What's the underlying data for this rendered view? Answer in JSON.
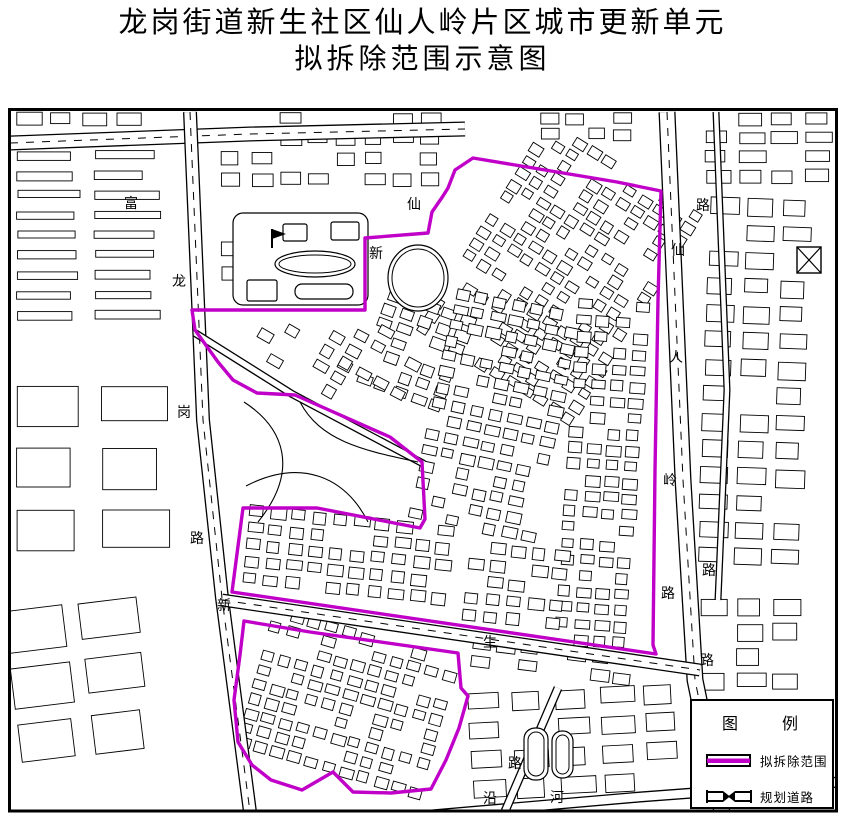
{
  "title": {
    "line1": "龙岗街道新生社区仙人岭片区城市更新单元",
    "line2": "拟拆除范围示意图"
  },
  "legend": {
    "title": "图　例",
    "items": [
      {
        "label": "拟拆除范围",
        "symbol": "demolition-boundary"
      },
      {
        "label": "规划道路",
        "symbol": "planned-road"
      }
    ]
  },
  "colors": {
    "ink": "#000000",
    "paper": "#ffffff",
    "boundary": "#c000c8"
  },
  "map": {
    "labels": [
      {
        "t": "富",
        "x": 131,
        "y": 208
      },
      {
        "t": "龙",
        "x": 179,
        "y": 286
      },
      {
        "t": "岗",
        "x": 184,
        "y": 417
      },
      {
        "t": "路",
        "x": 197,
        "y": 543
      },
      {
        "t": "仙",
        "x": 414,
        "y": 209
      },
      {
        "t": "新",
        "x": 376,
        "y": 258
      },
      {
        "t": "仙",
        "x": 678,
        "y": 255
      },
      {
        "t": "人",
        "x": 676,
        "y": 362
      },
      {
        "t": "岭",
        "x": 670,
        "y": 485
      },
      {
        "t": "路",
        "x": 668,
        "y": 598
      },
      {
        "t": "路",
        "x": 703,
        "y": 210
      },
      {
        "t": "路",
        "x": 709,
        "y": 575
      },
      {
        "t": "路",
        "x": 707,
        "y": 665
      },
      {
        "t": "新",
        "x": 224,
        "y": 610
      },
      {
        "t": "生",
        "x": 490,
        "y": 647
      },
      {
        "t": "路",
        "x": 515,
        "y": 768
      },
      {
        "t": "沿",
        "x": 490,
        "y": 803
      },
      {
        "t": "河",
        "x": 557,
        "y": 802
      }
    ],
    "boundary_main": [
      [
        473,
        158
      ],
      [
        617,
        182
      ],
      [
        661,
        191
      ],
      [
        658,
        300
      ],
      [
        655,
        470
      ],
      [
        653,
        645
      ],
      [
        656,
        654
      ],
      [
        232,
        592
      ],
      [
        243,
        508
      ],
      [
        317,
        508
      ],
      [
        420,
        528
      ],
      [
        425,
        519
      ],
      [
        422,
        462
      ],
      [
        390,
        437
      ],
      [
        295,
        395
      ],
      [
        257,
        393
      ],
      [
        233,
        380
      ],
      [
        218,
        362
      ],
      [
        195,
        330
      ],
      [
        192,
        310
      ],
      [
        365,
        310
      ],
      [
        365,
        238
      ],
      [
        428,
        233
      ],
      [
        432,
        212
      ],
      [
        443,
        196
      ],
      [
        448,
        188
      ],
      [
        455,
        170
      ]
    ],
    "boundary_south": [
      [
        244,
        621
      ],
      [
        310,
        632
      ],
      [
        458,
        653
      ],
      [
        461,
        688
      ],
      [
        468,
        696
      ],
      [
        459,
        728
      ],
      [
        446,
        760
      ],
      [
        431,
        789
      ],
      [
        391,
        793
      ],
      [
        353,
        792
      ],
      [
        333,
        772
      ],
      [
        302,
        790
      ],
      [
        271,
        780
      ],
      [
        252,
        765
      ],
      [
        238,
        742
      ],
      [
        234,
        700
      ],
      [
        240,
        655
      ]
    ],
    "roads": [
      {
        "pts": [
          [
            10,
            143
          ],
          [
            250,
            134
          ],
          [
            465,
            129
          ]
        ],
        "w": 15,
        "dash": true
      },
      {
        "pts": [
          [
            190,
            112
          ],
          [
            203,
            420
          ],
          [
            222,
            598
          ],
          [
            250,
            812
          ]
        ],
        "w": 14,
        "dash": true
      },
      {
        "pts": [
          [
            667,
            112
          ],
          [
            683,
            480
          ],
          [
            695,
            680
          ],
          [
            722,
            812
          ]
        ],
        "w": 17,
        "dash": true
      },
      {
        "pts": [
          [
            222,
            600
          ],
          [
            700,
            670
          ]
        ],
        "w": 13,
        "dash": true
      },
      {
        "pts": [
          [
            420,
            816
          ],
          [
            640,
            797
          ],
          [
            840,
            782
          ]
        ],
        "w": 11,
        "dash": false
      },
      {
        "pts": [
          [
            558,
            688
          ],
          [
            503,
            816
          ]
        ],
        "w": 9,
        "dash": false
      },
      {
        "pts": [
          [
            716,
            112
          ],
          [
            727,
            390
          ],
          [
            718,
            600
          ]
        ],
        "w": 7,
        "dash": false
      },
      {
        "pts": [
          [
            195,
            333
          ],
          [
            292,
            394
          ],
          [
            424,
            464
          ]
        ],
        "w": 8,
        "dash": false
      }
    ],
    "clusters": [
      {
        "x": 16,
        "y": 112,
        "w": 170,
        "h": 24,
        "a": 0,
        "cw": 26,
        "ch": 13,
        "gx": 7,
        "gy": 6,
        "d": 0.85
      },
      {
        "x": 16,
        "y": 150,
        "w": 162,
        "h": 180,
        "a": 0,
        "cw": 66,
        "ch": 9,
        "gx": 12,
        "gy": 11,
        "d": 0.92
      },
      {
        "x": 16,
        "y": 385,
        "w": 168,
        "h": 200,
        "a": 0,
        "cw": 70,
        "ch": 44,
        "gx": 15,
        "gy": 18,
        "d": 0.85
      },
      {
        "x": 14,
        "y": 598,
        "w": 210,
        "h": 208,
        "a": -7,
        "cw": 62,
        "ch": 42,
        "gx": 13,
        "gy": 15,
        "d": 0.85
      },
      {
        "x": 252,
        "y": 112,
        "w": 205,
        "h": 88,
        "a": 0,
        "cw": 21,
        "ch": 13,
        "gx": 7,
        "gy": 7,
        "d": 0.7
      },
      {
        "x": 468,
        "y": 148,
        "w": 185,
        "h": 250,
        "a": 32,
        "cw": 13,
        "ch": 10,
        "gx": 4,
        "gy": 4,
        "d": 0.75
      },
      {
        "x": 540,
        "y": 112,
        "w": 112,
        "h": 30,
        "a": 0,
        "cw": 19,
        "ch": 11,
        "gx": 5,
        "gy": 5,
        "d": 0.8
      },
      {
        "x": 368,
        "y": 300,
        "w": 95,
        "h": 112,
        "a": 20,
        "cw": 15,
        "ch": 11,
        "gx": 4,
        "gy": 4,
        "d": 0.75
      },
      {
        "x": 430,
        "y": 298,
        "w": 132,
        "h": 244,
        "a": 12,
        "cw": 15,
        "ch": 11,
        "gx": 4,
        "gy": 5,
        "d": 0.78
      },
      {
        "x": 566,
        "y": 300,
        "w": 88,
        "h": 348,
        "a": 4,
        "cw": 15,
        "ch": 11,
        "gx": 4,
        "gy": 5,
        "d": 0.85
      },
      {
        "x": 345,
        "y": 330,
        "w": 82,
        "h": 60,
        "a": 28,
        "cw": 15,
        "ch": 11,
        "gx": 5,
        "gy": 5,
        "d": 0.55
      },
      {
        "x": 245,
        "y": 515,
        "w": 215,
        "h": 80,
        "a": 6,
        "cw": 16,
        "ch": 12,
        "gx": 5,
        "gy": 5,
        "d": 0.85
      },
      {
        "x": 465,
        "y": 545,
        "w": 100,
        "h": 96,
        "a": 6,
        "cw": 16,
        "ch": 12,
        "gx": 5,
        "gy": 5,
        "d": 0.8
      },
      {
        "x": 250,
        "y": 630,
        "w": 200,
        "h": 150,
        "a": 16,
        "cw": 14,
        "ch": 11,
        "gx": 4,
        "gy": 4,
        "d": 0.78
      },
      {
        "x": 705,
        "y": 112,
        "w": 130,
        "h": 78,
        "a": 0,
        "cw": 27,
        "ch": 13,
        "gx": 6,
        "gy": 6,
        "d": 0.85
      },
      {
        "x": 703,
        "y": 198,
        "w": 133,
        "h": 384,
        "a": 2,
        "cw": 29,
        "ch": 18,
        "gx": 8,
        "gy": 9,
        "d": 0.8
      },
      {
        "x": 700,
        "y": 598,
        "w": 136,
        "h": 92,
        "a": 0,
        "cw": 29,
        "ch": 17,
        "gx": 7,
        "gy": 8,
        "d": 0.75
      },
      {
        "x": 470,
        "y": 688,
        "w": 216,
        "h": 118,
        "a": -3,
        "cw": 35,
        "ch": 20,
        "gx": 9,
        "gy": 9,
        "d": 0.7
      },
      {
        "x": 470,
        "y": 648,
        "w": 185,
        "h": 34,
        "a": 7,
        "cw": 19,
        "ch": 12,
        "gx": 5,
        "gy": 5,
        "d": 0.6
      },
      {
        "x": 220,
        "y": 150,
        "w": 30,
        "h": 185,
        "a": 0,
        "cw": 22,
        "ch": 14,
        "gx": 6,
        "gy": 9,
        "d": 0.6
      },
      {
        "x": 255,
        "y": 318,
        "w": 100,
        "h": 68,
        "a": 30,
        "cw": 15,
        "ch": 11,
        "gx": 6,
        "gy": 6,
        "d": 0.5
      }
    ],
    "features": [
      {
        "type": "rrect",
        "x": 233,
        "y": 213,
        "w": 135,
        "h": 92,
        "r": 10
      },
      {
        "type": "ellipse",
        "cx": 315,
        "cy": 264,
        "rx": 40,
        "ry": 13,
        "dbl": true
      },
      {
        "type": "rrect",
        "x": 295,
        "y": 284,
        "w": 58,
        "h": 15,
        "r": 7
      },
      {
        "type": "rrect",
        "x": 283,
        "y": 224,
        "w": 24,
        "h": 17,
        "r": 2
      },
      {
        "type": "rrect",
        "x": 331,
        "y": 222,
        "w": 28,
        "h": 18,
        "r": 2
      },
      {
        "type": "rrect",
        "x": 247,
        "y": 280,
        "w": 30,
        "h": 21,
        "r": 2
      },
      {
        "type": "flag",
        "x": 272,
        "y": 229
      },
      {
        "type": "ellipse",
        "cx": 418,
        "cy": 278,
        "rx": 30,
        "ry": 33,
        "dbl": true
      },
      {
        "type": "path",
        "d": "M244,402 C284,428 300,470 258,522"
      },
      {
        "type": "path",
        "d": "M246,486 C300,458 345,476 368,522"
      },
      {
        "type": "path",
        "d": "M300,402 C320,440 360,450 418,462"
      },
      {
        "type": "rrect",
        "x": 524,
        "y": 728,
        "w": 24,
        "h": 52,
        "r": 11,
        "dbl": true
      },
      {
        "type": "rrect",
        "x": 552,
        "y": 731,
        "w": 21,
        "h": 47,
        "r": 10,
        "dbl": true
      },
      {
        "type": "xbox",
        "x": 797,
        "y": 247,
        "w": 24,
        "h": 26
      }
    ]
  }
}
